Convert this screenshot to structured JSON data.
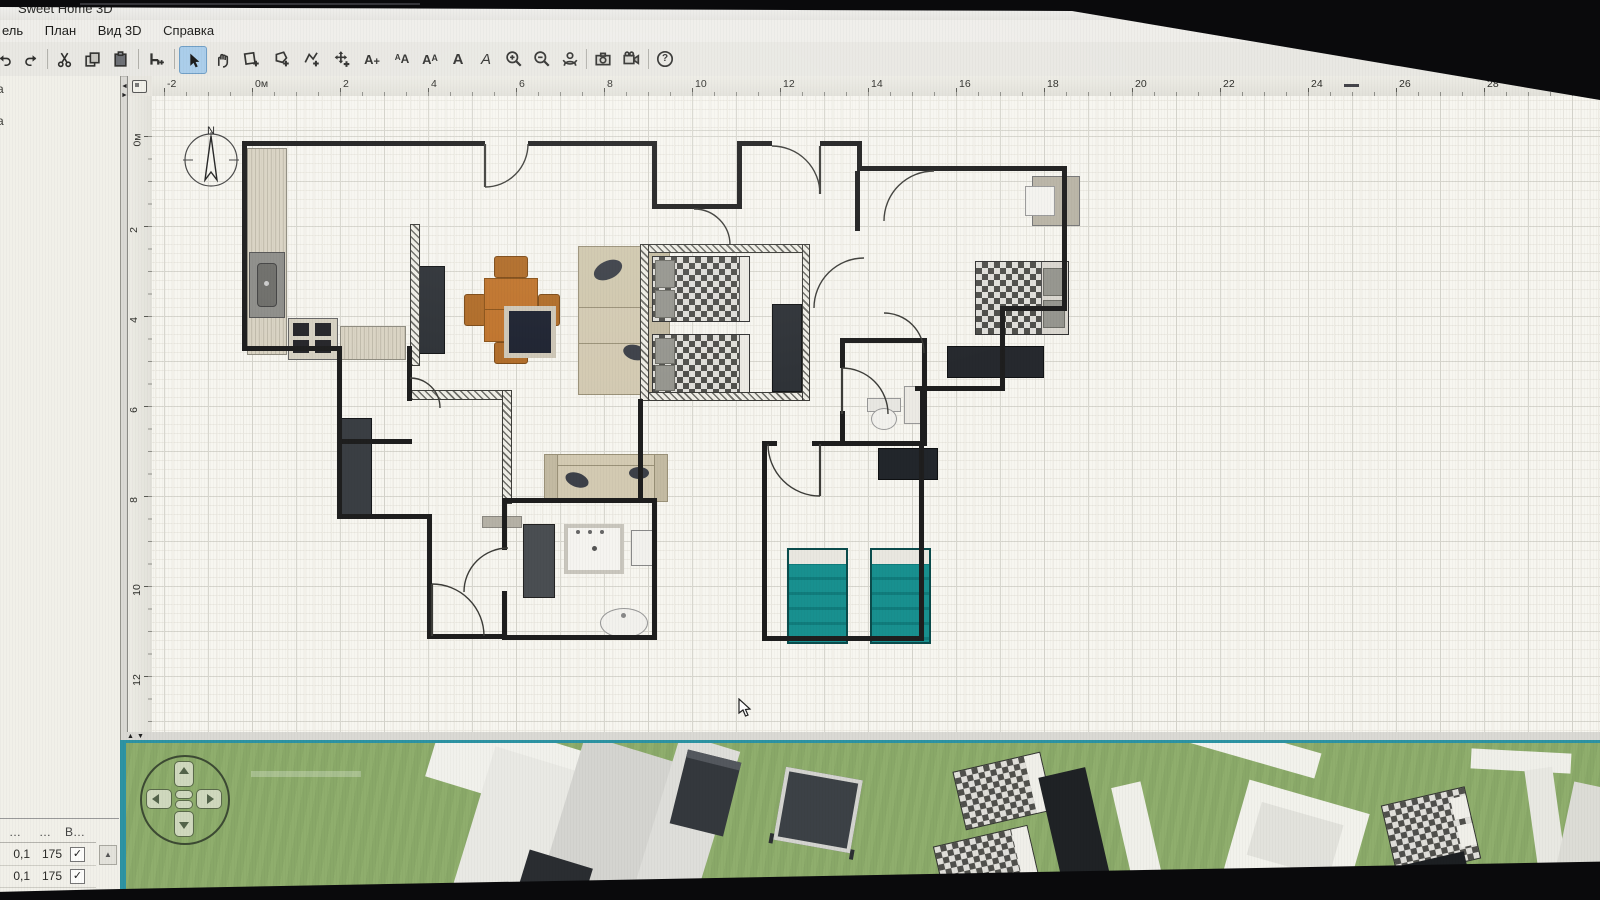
{
  "window": {
    "title": "Sweet Home 3D"
  },
  "menu": {
    "items": [
      "ель",
      "План",
      "Вид 3D",
      "Справка"
    ]
  },
  "toolbar": {
    "tools": [
      "undo",
      "redo",
      "cut",
      "copy",
      "paste",
      "add-furniture",
      "select",
      "pan",
      "create-walls",
      "create-rooms",
      "create-polylines",
      "create-dimensions",
      "add-text",
      "decrease-text-size",
      "increase-text-size",
      "bold",
      "italic",
      "zoom-in",
      "zoom-out",
      "virtual-visit",
      "create-photo",
      "create-video",
      "help"
    ],
    "active_tool": "select",
    "a_glyph": "A",
    "aa_small_glyph": "ᴬA",
    "aa_big_glyph": "Aᴬ",
    "plus_glyph": "+",
    "help_glyph": "?"
  },
  "plan": {
    "h_ruler_labels": [
      "-2",
      "0м",
      "2",
      "4",
      "6",
      "8",
      "10",
      "12",
      "14",
      "16",
      "18",
      "20",
      "22",
      "24",
      "26",
      "28"
    ],
    "v_ruler_labels": [
      "0м",
      "2",
      "4",
      "6",
      "8",
      "10",
      "12"
    ],
    "compass_north": "N"
  },
  "catalog": {
    "partial_labels": [
      "а",
      "а"
    ]
  },
  "furniture_table": {
    "headers": [
      "…",
      "…",
      "В…"
    ],
    "rows": [
      {
        "c1": "0,1",
        "c2": "175",
        "visible": true
      },
      {
        "c1": "0,1",
        "c2": "175",
        "visible": true
      }
    ],
    "check_glyph": "✓",
    "scroll_up_glyph": "▲"
  },
  "colors": {
    "selection_blue": "#a9cdea",
    "view3d_border_teal": "#2d93a3",
    "grass_green": "#8fae6d",
    "bed_teal": "#18908f",
    "dining_orange": "#c0742c"
  }
}
